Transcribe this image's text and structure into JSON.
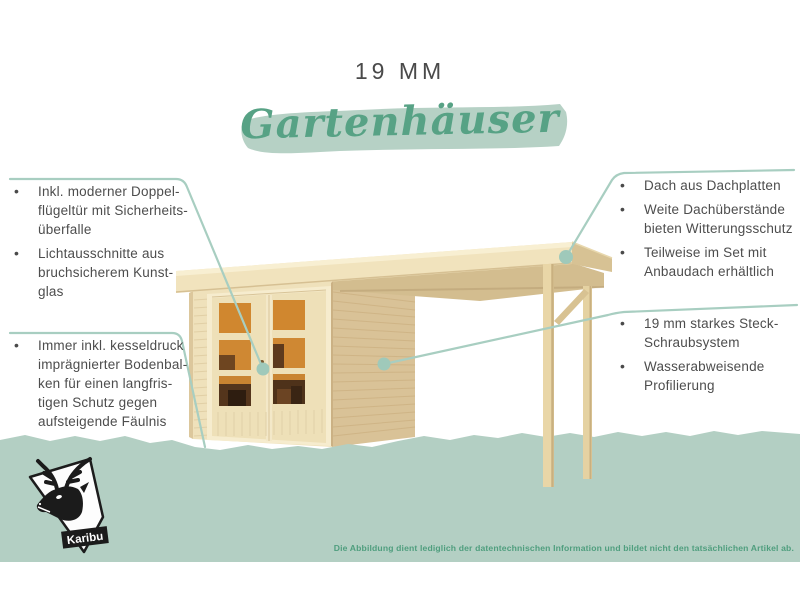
{
  "title": {
    "mm": "19 MM",
    "script": "Gartenhäuser"
  },
  "callouts": {
    "top_left": {
      "bullets": [
        {
          "lines": [
            "Inkl. moderner Doppel-",
            "flügeltür mit Sicherheits-",
            "überfalle"
          ]
        },
        {
          "lines": [
            "Lichtausschnitte aus",
            "bruchsicherem Kunst-",
            "glas"
          ]
        }
      ]
    },
    "bottom_left": {
      "bullets": [
        {
          "lines": [
            "Immer inkl. kesseldruck",
            "imprägnierter Bodenbal-",
            "ken für einen langfris-",
            "tigen Schutz gegen",
            "aufsteigende Fäulnis"
          ]
        }
      ]
    },
    "top_right": {
      "bullets": [
        {
          "lines": [
            "Dach aus Dachplatten"
          ]
        },
        {
          "lines": [
            "Weite Dachüberstände",
            "bieten Witterungsschutz"
          ]
        },
        {
          "lines": [
            "Teilweise im Set mit",
            "Anbaudach erhältlich"
          ]
        }
      ]
    },
    "bottom_right": {
      "bullets": [
        {
          "lines": [
            "19 mm starkes Steck-",
            "Schraubsystem"
          ]
        },
        {
          "lines": [
            "Wasserabweisende",
            "Profilierung"
          ]
        }
      ]
    }
  },
  "footer": {
    "disclaimer": "Die Abbildung dient lediglich der datentechnischen Information und bildet nicht den tatsächlichen Artikel ab."
  },
  "logo": {
    "brand": "Karibu"
  },
  "colors": {
    "accent_green": "#57a285",
    "band_green": "#b3cfc3",
    "brush_green": "#b6d1c5",
    "callout_line": "#a8cec1",
    "text_dark": "#4a4a4a",
    "disclaimer_green": "#4f9e7e",
    "wood_light": "#f1e3bd",
    "wood_wall": "#efe1bb",
    "wood_side": "#d9c297",
    "window_orange": "#d0872f"
  }
}
